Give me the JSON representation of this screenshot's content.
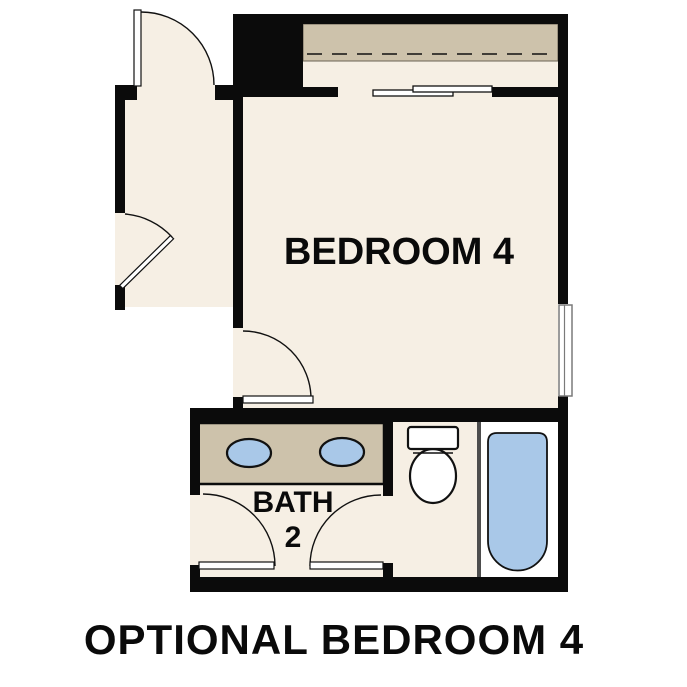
{
  "caption": "OPTIONAL BEDROOM 4",
  "labels": {
    "bedroom": "BEDROOM 4",
    "bath_line1": "BATH",
    "bath_line2": "2"
  },
  "colors": {
    "floor": "#f6efe4",
    "millwork_tan": "#cdc2ab",
    "fixture_blue": "#a9c8e8",
    "wall": "#0b0b0b",
    "thin_partition": "#4d4d4d",
    "window_frame": "#7a7a7a",
    "tub_room_floor": "#ffffff",
    "label_text": "#0a0a0a"
  },
  "fixtures": [
    "closet-shelf-and-rod",
    "bypass-sliding-closet-doors",
    "double-sink-vanity",
    "toilet",
    "bathtub",
    "window",
    "hinged-door-top-hall",
    "hinged-door-side-hall",
    "hinged-door-bedroom",
    "hinged-door-bath-entry",
    "hinged-door-toilet-compartment"
  ]
}
